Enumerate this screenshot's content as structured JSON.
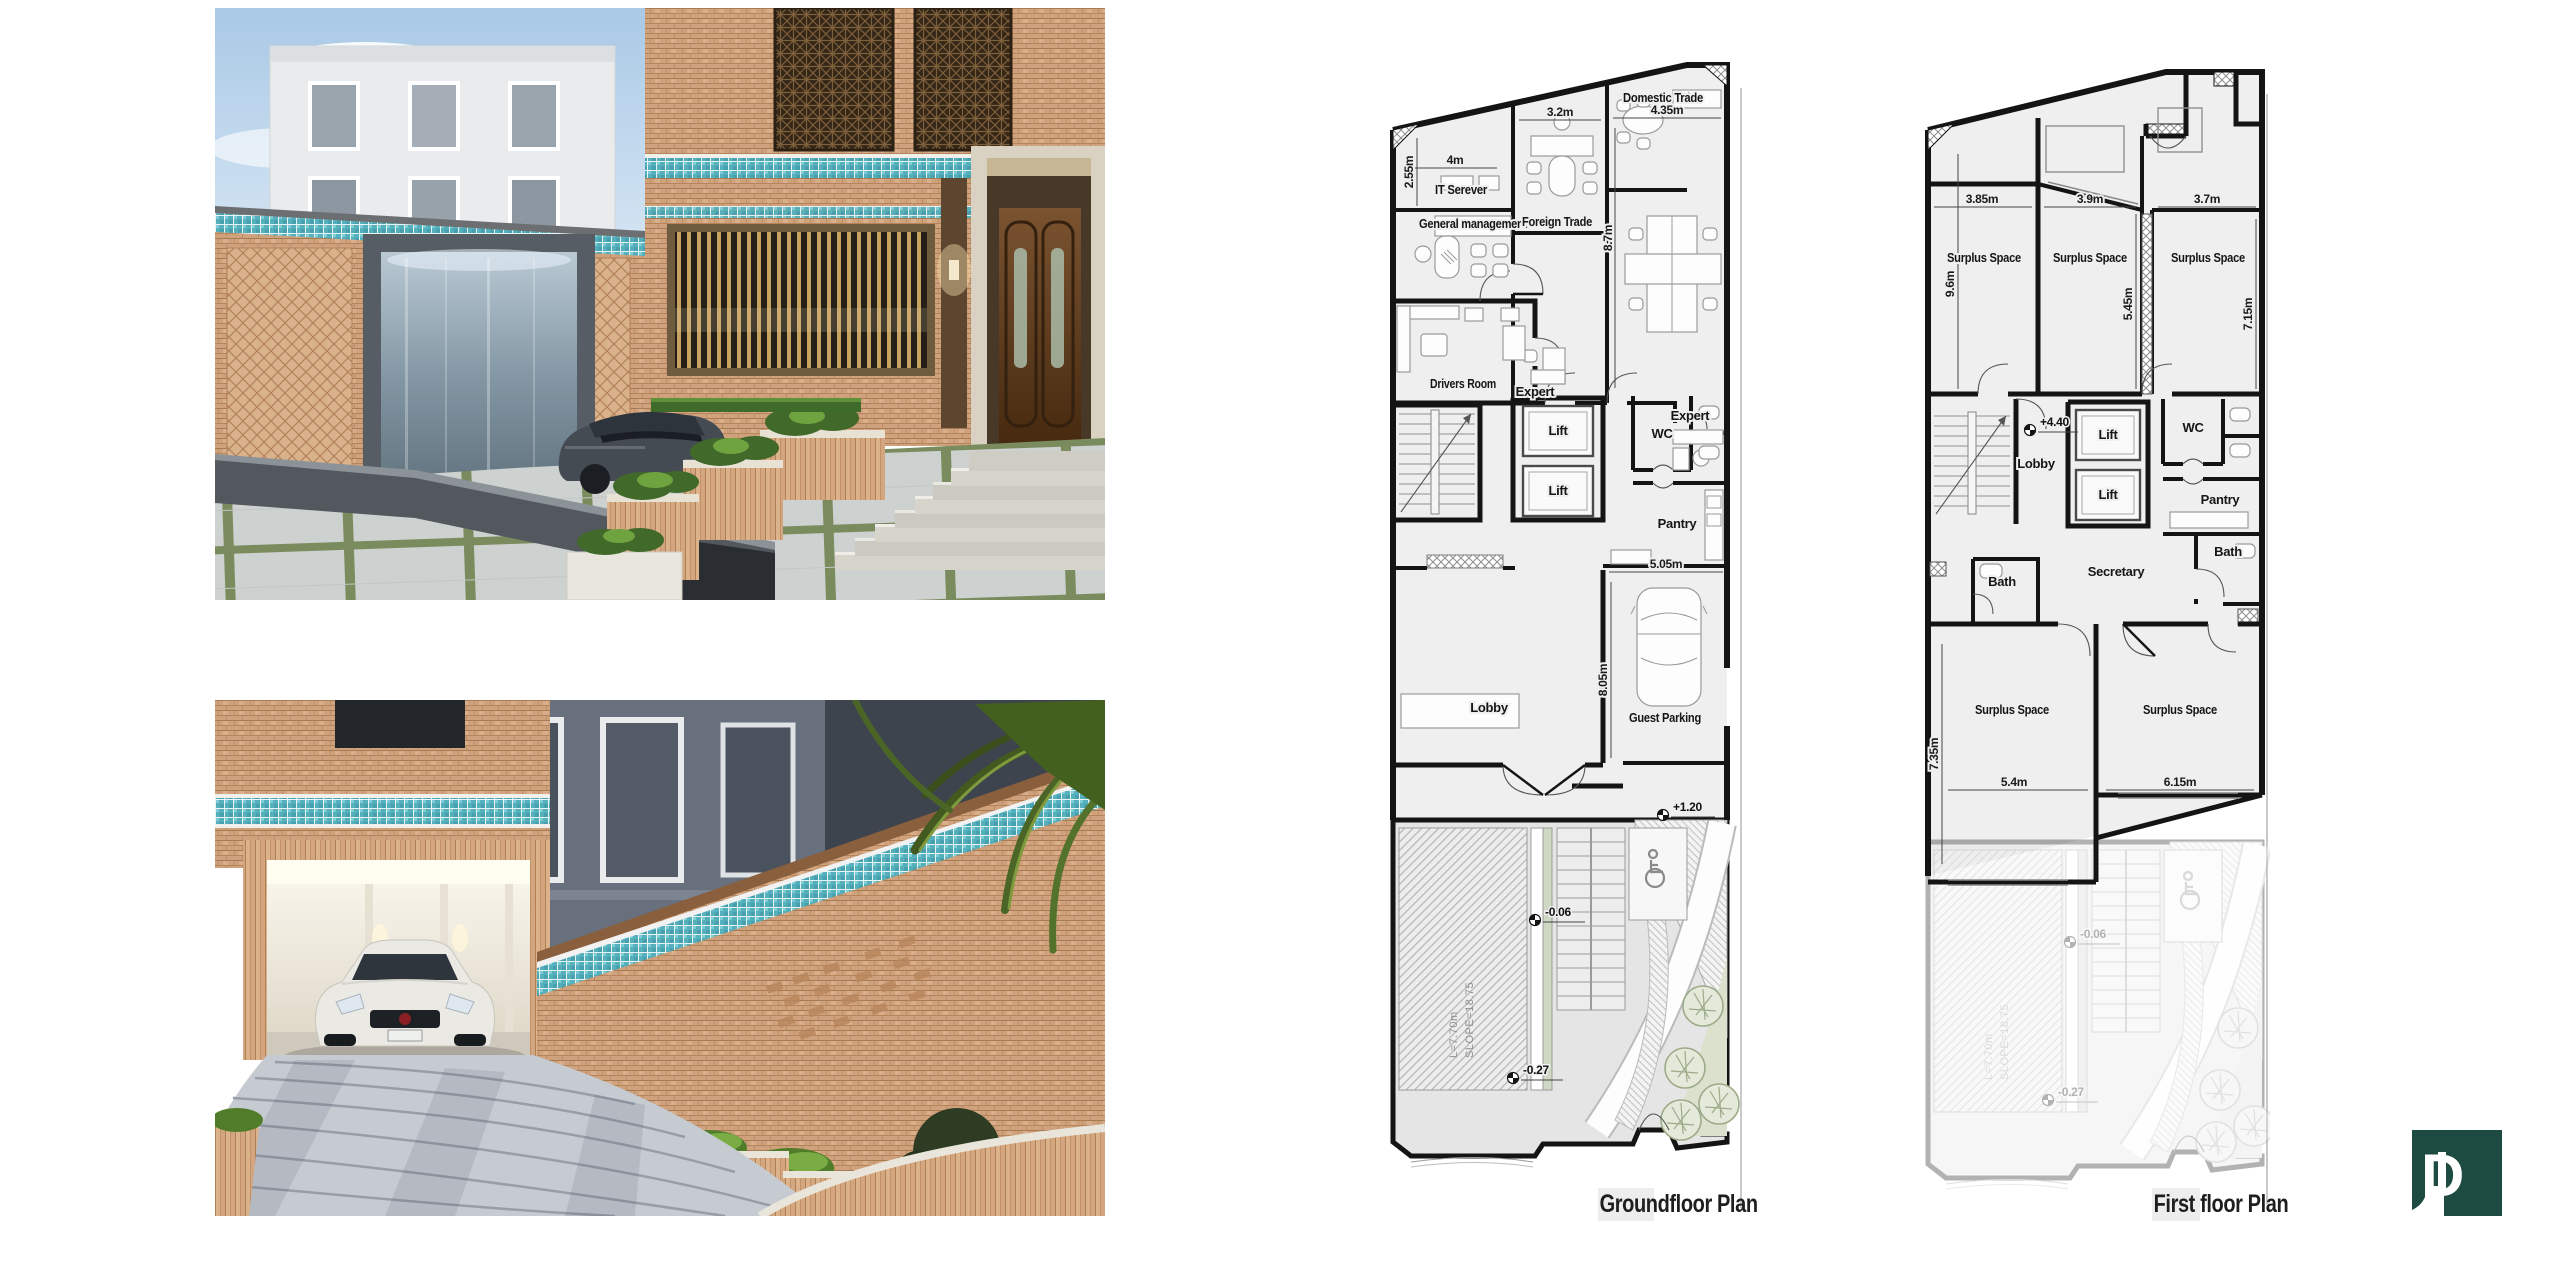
{
  "colors": {
    "logo_green": "#1d4b41",
    "tile_turquoise": "#5fb9c3",
    "plan_wall": "#141414",
    "plan_floor": "#efefef",
    "landscape_green": "#dbe1cd"
  },
  "plans": {
    "ground": {
      "title": "Groundfloor Plan",
      "rooms": {
        "it_server": "IT Serever",
        "general_management": "General management",
        "foreign_trade": "Foreign Trade",
        "domestic_trade": "Domestic Trade",
        "expert_left": "Expert",
        "expert_right": "Expert",
        "drivers_room": "Drivers Room",
        "lift_upper": "Lift",
        "lift_lower": "Lift",
        "wc": "WC",
        "pantry": "Pantry",
        "lobby": "Lobby",
        "guest_parking": "Guest Parking"
      },
      "dims": {
        "it_width": "4m",
        "it_depth": "2.55m",
        "foreign_width": "3.2m",
        "domestic_width": "4.35m",
        "office_depth": "8.7m",
        "parking_width": "5.05m",
        "parking_depth": "8.05m"
      },
      "levels": {
        "terrace": "+1.20",
        "entry": "-0.06",
        "street": "-0.27"
      },
      "ramp": {
        "length": "L=7.70m",
        "slope": "SLOPE=18.75"
      }
    },
    "first": {
      "title": "First floor Plan",
      "rooms": {
        "surplus_top_left": "Surplus Space",
        "surplus_top_mid": "Surplus Space",
        "surplus_top_right": "Surplus Space",
        "surplus_low_left": "Surplus Space",
        "surplus_low_right": "Surplus Space",
        "lobby": "Lobby",
        "lift_upper": "Lift",
        "lift_lower": "Lift",
        "wc": "WC",
        "pantry": "Pantry",
        "bath_left": "Bath",
        "bath_right": "Bath",
        "secretary": "Secretary"
      },
      "dims": {
        "top_left_width": "3.85m",
        "top_mid_width": "3.9m",
        "top_right_width": "3.7m",
        "left_depth": "9.6m",
        "mid_depth": "5.45m",
        "right_depth": "7.15m",
        "low_left_depth": "7.35m",
        "low_left_width": "5.4m",
        "low_right_width": "6.15m"
      },
      "levels": {
        "floor": "+4.40"
      }
    }
  },
  "logo": {
    "glyph": "D"
  }
}
